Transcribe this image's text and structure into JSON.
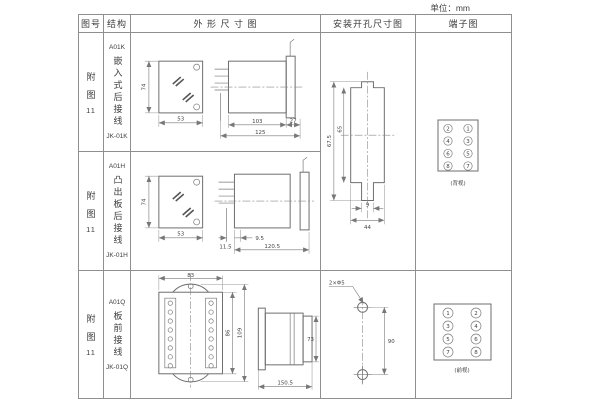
{
  "unit_label": "单位：mm",
  "headers": {
    "fig_no": "图号",
    "structure": "结构",
    "outline": "外 形 尺 寸 图",
    "mounting": "安装开孔尺寸图",
    "terminal": "端子图"
  },
  "rows": [
    {
      "fig_lines": [
        "附",
        "图",
        "11"
      ],
      "model": "A01K",
      "structure_text": "嵌入式后接线",
      "type_code": "JK-01K"
    },
    {
      "fig_lines": [
        "附",
        "图",
        "11"
      ],
      "model": "A01H",
      "structure_text": "凸出板后接线",
      "type_code": "JK-01H"
    },
    {
      "fig_lines": [
        "附",
        "图",
        "11"
      ],
      "model": "A01Q",
      "structure_text": "板前接线",
      "type_code": "JK-01Q"
    }
  ],
  "outline1": {
    "h": "74",
    "w": "53",
    "body": "103",
    "tail": "27",
    "total": "125"
  },
  "outline2": {
    "h": "74",
    "w": "53",
    "offset": "9.5",
    "panel": "11.5",
    "total": "120.5"
  },
  "outline3": {
    "top_w": "83",
    "inner_h": "86",
    "outer_h": "109",
    "depth": "150.5",
    "side_h": "73"
  },
  "mounting12": {
    "outer_h": "67.5",
    "inner_h": "65",
    "slot_w": "9",
    "cutout_w": "44"
  },
  "mounting3": {
    "holes": "2×Φ5",
    "spacing": "90"
  },
  "terminal12": {
    "left": [
      "2",
      "4",
      "6",
      "8"
    ],
    "right": [
      "1",
      "3",
      "5",
      "7"
    ],
    "caption": "(背视)"
  },
  "terminal3": {
    "left": [
      "1",
      "3",
      "5",
      "7"
    ],
    "right": [
      "2",
      "4",
      "6",
      "8"
    ],
    "caption": "(前视)"
  }
}
